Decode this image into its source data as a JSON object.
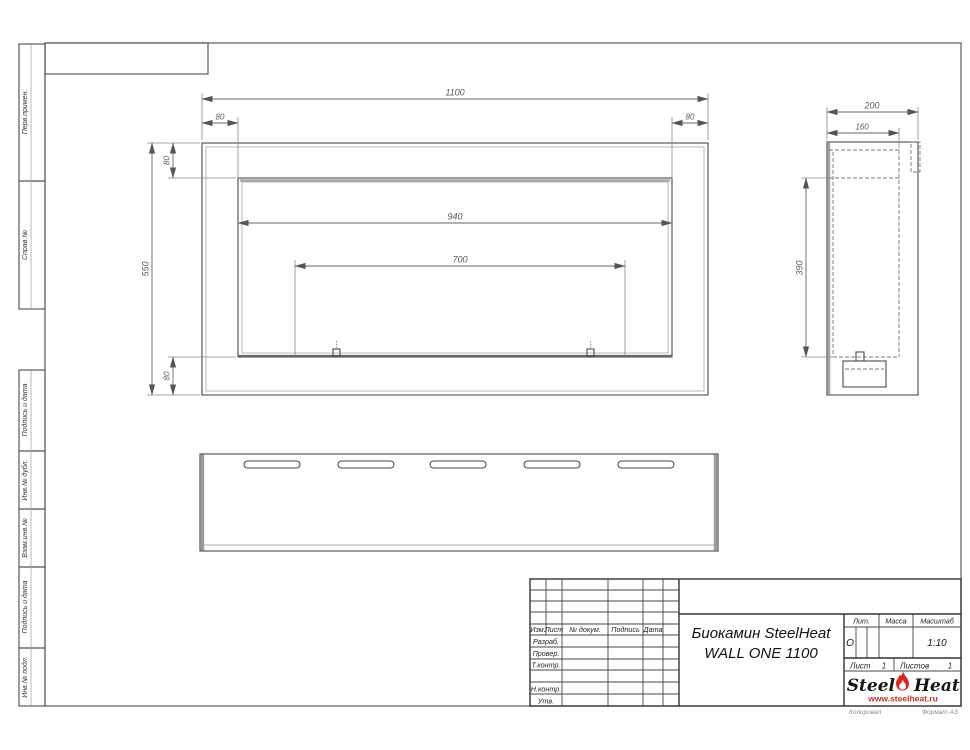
{
  "colors": {
    "accent": "#d6281c",
    "line": "#4a4a4a"
  },
  "dims": {
    "front": {
      "total": "1100",
      "left_inset": "80",
      "right_inset": "80",
      "top_inset": "80",
      "height": "550",
      "bottom_inset": "80",
      "opening_width": "940",
      "burner_span": "700"
    },
    "side": {
      "depth": "200",
      "inner_depth": "160",
      "opening_height": "390"
    }
  },
  "margin": {
    "labels": [
      "Перв.примен.",
      "Справ.№",
      "Подпись и дата",
      "Инв.№ дубл.",
      "Взам.инв.№",
      "Подпись и дата",
      "Инв.№ подл."
    ]
  },
  "title_block": {
    "rev_cols": [
      "Изм.",
      "Лист",
      "№ докум.",
      "Подпись",
      "Дата"
    ],
    "roles": [
      "Разраб.",
      "Провер.",
      "Т.контр.",
      "Н.контр.",
      "Утв."
    ],
    "product": {
      "line1": "Биокамин SteelHeat",
      "line2": "WALL ONE 1100"
    },
    "props": {
      "lit_header": "Лит.",
      "mass_header": "Масса",
      "scale_header": "Масштаб",
      "litera": "О",
      "scale": "1:10"
    },
    "sheet": {
      "label": "Лист",
      "num": "1",
      "of_label": "Листов",
      "of_num": "1"
    },
    "logo": {
      "steel": "Steel",
      "heat": "Heat",
      "site": "www.steelheat.ru"
    },
    "footer": {
      "copy": "Копировал",
      "format": "Формат А3"
    }
  }
}
